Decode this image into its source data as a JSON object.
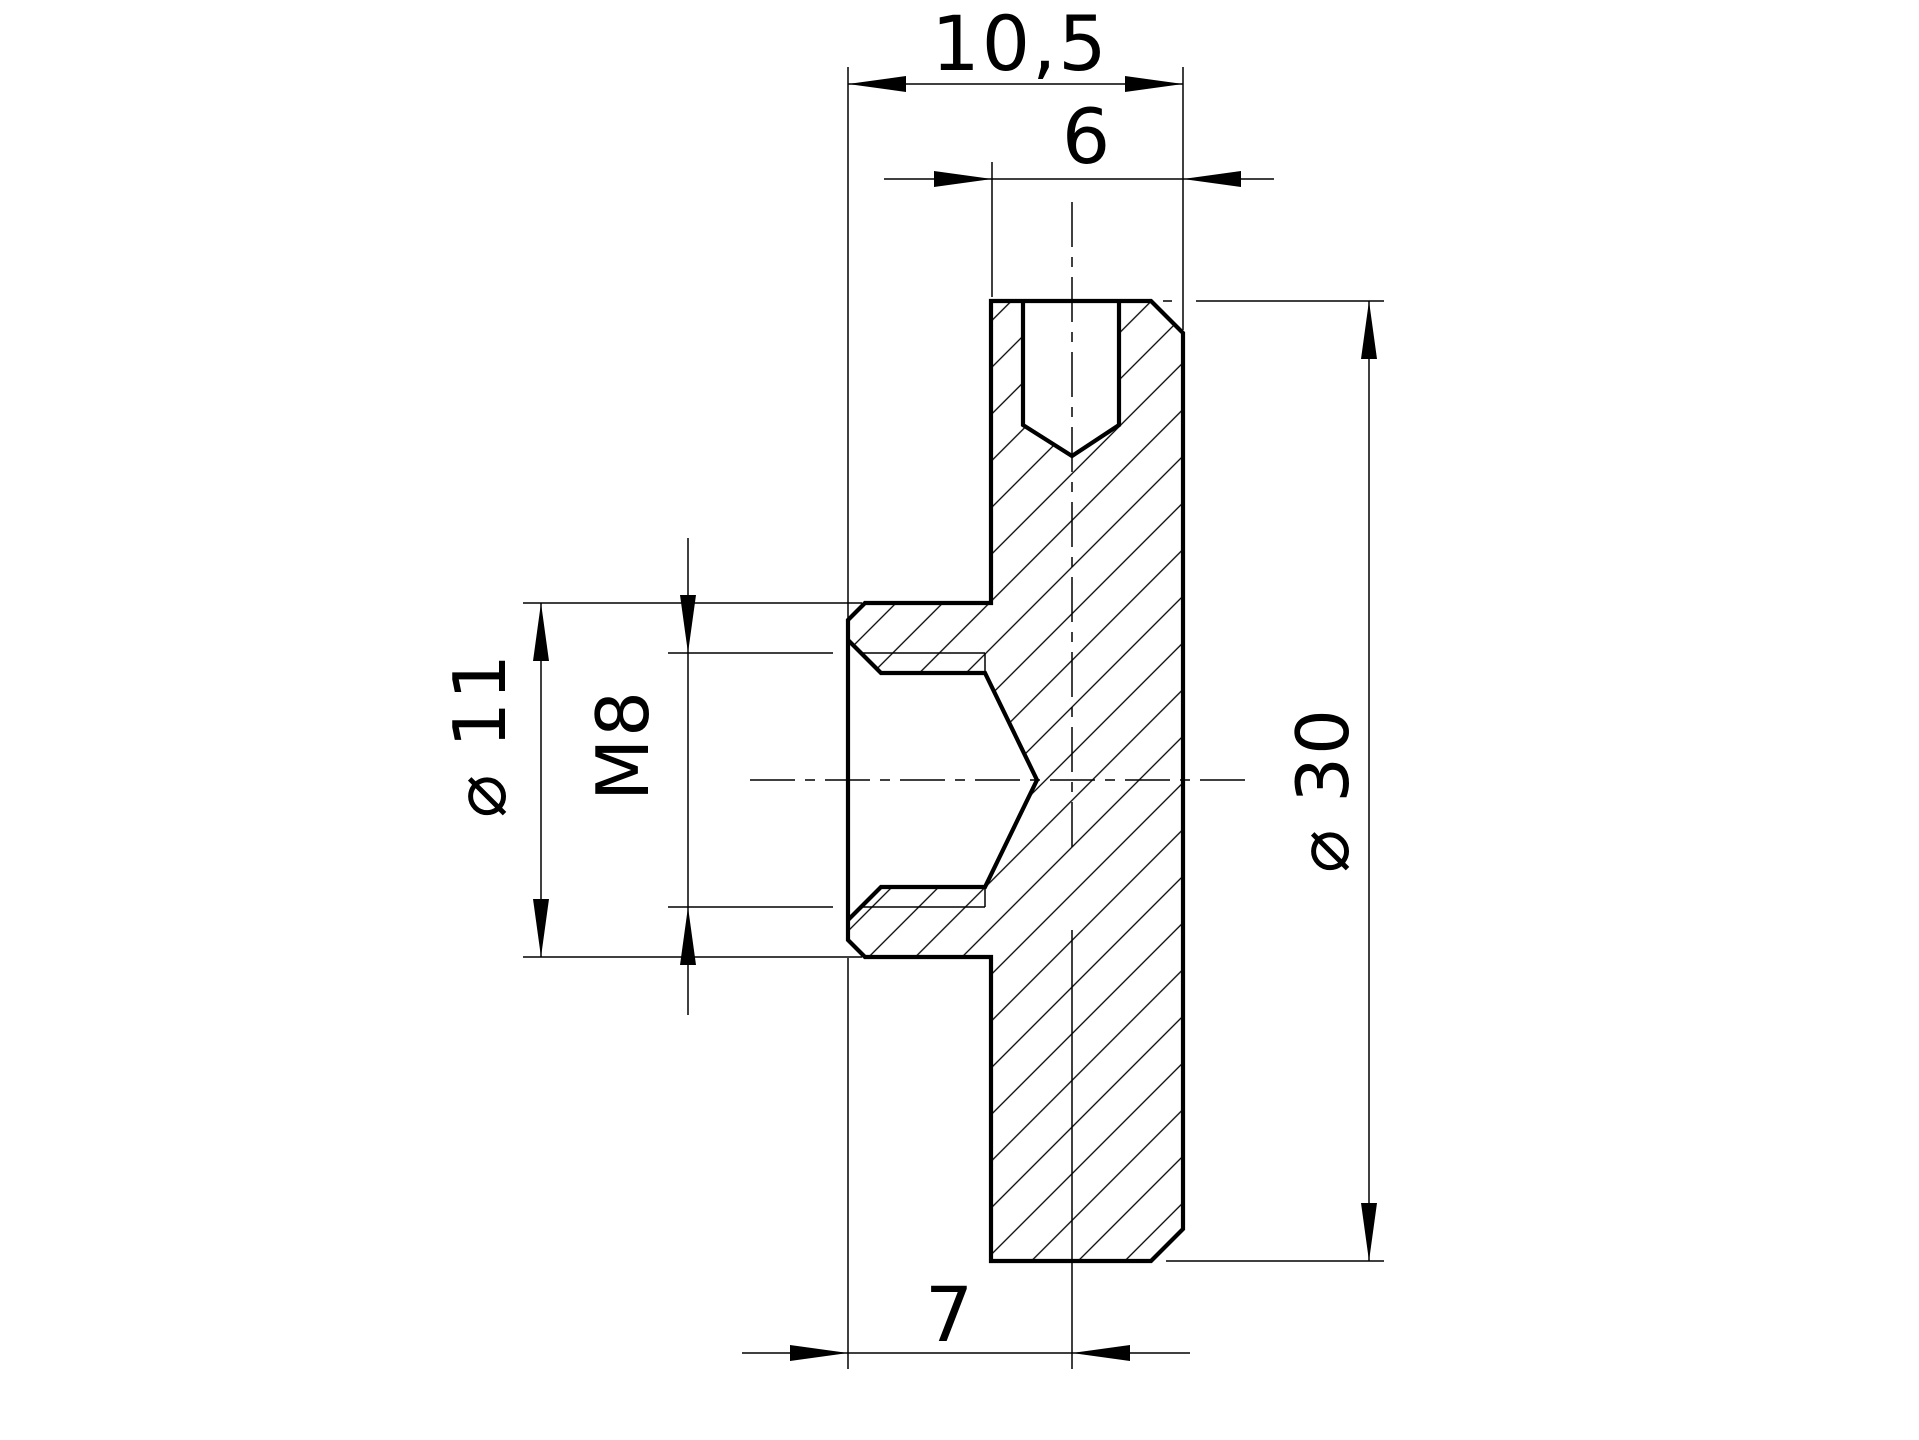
{
  "drawing": {
    "background_color": "#ffffff",
    "line_color": "#000000",
    "view": "cross-section",
    "dimensions": {
      "width_total": "10,5",
      "width_upper_step": "6",
      "boss_diameter": "⌀ 11",
      "thread_size": "M8",
      "outer_diameter": "⌀ 30",
      "hole_axis_offset": "7"
    }
  }
}
